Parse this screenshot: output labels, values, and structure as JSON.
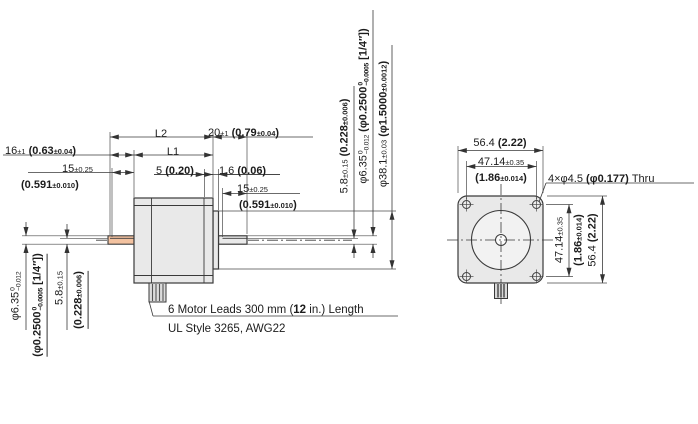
{
  "colors": {
    "line": "#3a3a3a",
    "part_fill": "#e9e9e9",
    "flange_fill": "#ededed",
    "shaft_highlight": "#f3c2a0"
  },
  "side_view": {
    "dims": {
      "l2": [
        {
          "t": "L2",
          "c": "m"
        }
      ],
      "l1": [
        {
          "t": "L1",
          "c": "m"
        }
      ],
      "front_shaft_len": [
        {
          "t": "20",
          "c": "m"
        },
        {
          "t": "±1",
          "c": "t"
        },
        {
          "t": " (0.79",
          "c": "b"
        },
        {
          "t": "±0.04",
          "c": "bt"
        },
        {
          "t": ")",
          "c": "b"
        }
      ],
      "rear_shaft_len": [
        {
          "t": "16",
          "c": "m"
        },
        {
          "t": "±1",
          "c": "t"
        },
        {
          "t": " (0.63",
          "c": "b"
        },
        {
          "t": "±0.04",
          "c": "bt"
        },
        {
          "t": ")",
          "c": "b"
        }
      ],
      "flat15_m": [
        {
          "t": "15",
          "c": "m"
        },
        {
          "t": "±0.25",
          "c": "t"
        }
      ],
      "flat15_i": [
        {
          "t": "(0.591",
          "c": "b"
        },
        {
          "t": "±0.010",
          "c": "bt"
        },
        {
          "t": ")",
          "c": "b"
        }
      ],
      "front_step": [
        {
          "t": "5 ",
          "c": "m"
        },
        {
          "t": "(0.20)",
          "c": "b"
        }
      ],
      "pilot_thk": [
        {
          "t": "1.6 ",
          "c": "m"
        },
        {
          "t": "(0.06)",
          "c": "b"
        }
      ],
      "shaft_flat_full": [
        {
          "t": "5.8",
          "c": "m"
        },
        {
          "t": "±0.15",
          "c": "t"
        },
        {
          "t": " (0.228",
          "c": "b"
        },
        {
          "t": "±0.006",
          "c": "bt"
        },
        {
          "t": ")",
          "c": "b"
        }
      ],
      "shaft_dia_full": [
        {
          "t": "φ6.35",
          "c": "m"
        },
        {
          "up": "0",
          "dn": "−0.012",
          "c": "stk"
        },
        {
          "t": " (φ0.2500",
          "c": "b"
        },
        {
          "up": "0",
          "dn": "−0.0005",
          "c": "stkb"
        },
        {
          "t": " [1/4″])",
          "c": "b"
        }
      ],
      "pilot_dia": [
        {
          "t": "φ38.1",
          "c": "m"
        },
        {
          "t": "±0.03",
          "c": "t"
        },
        {
          "t": " (φ1.5000",
          "c": "b"
        },
        {
          "t": "±0.0012",
          "c": "bt"
        },
        {
          "t": ")",
          "c": "b"
        }
      ],
      "shaft_dia_m": [
        {
          "t": "φ6.35",
          "c": "m"
        },
        {
          "up": "0",
          "dn": "−0.012",
          "c": "stk"
        }
      ],
      "shaft_dia_i": [
        {
          "t": "(φ0.2500",
          "c": "b"
        },
        {
          "up": "0",
          "dn": "−0.0005",
          "c": "stkb"
        },
        {
          "t": " [1/4″])",
          "c": "b"
        }
      ],
      "shaft_flat_m": [
        {
          "t": "5.8",
          "c": "m"
        },
        {
          "t": "±0.15",
          "c": "t"
        }
      ],
      "shaft_flat_i": [
        {
          "t": "(0.228",
          "c": "b"
        },
        {
          "t": "±0.006",
          "c": "bt"
        },
        {
          "t": ")",
          "c": "b"
        }
      ]
    },
    "note": {
      "line1": [
        {
          "t": "6 Motor Leads 300 mm (",
          "c": "n"
        },
        {
          "t": "12",
          "c": "nb"
        },
        {
          "t": " in.) Length",
          "c": "n"
        }
      ],
      "line2": [
        {
          "t": "UL Style 3265, AWG22",
          "c": "n"
        }
      ]
    }
  },
  "front_view": {
    "dims": {
      "frame_size": [
        {
          "t": "56.4 ",
          "c": "m"
        },
        {
          "t": "(2.22)",
          "c": "b"
        }
      ],
      "bolt_cc_m": [
        {
          "t": "47.14",
          "c": "m"
        },
        {
          "t": "±0.35",
          "c": "t"
        }
      ],
      "bolt_cc_i": [
        {
          "t": "(1.86",
          "c": "b"
        },
        {
          "t": "±0.014",
          "c": "bt"
        },
        {
          "t": ")",
          "c": "b"
        }
      ],
      "holes": [
        {
          "t": "4×φ4.5 ",
          "c": "m"
        },
        {
          "t": "(φ0.177)",
          "c": "b"
        },
        {
          "t": " Thru",
          "c": "m"
        }
      ]
    }
  }
}
